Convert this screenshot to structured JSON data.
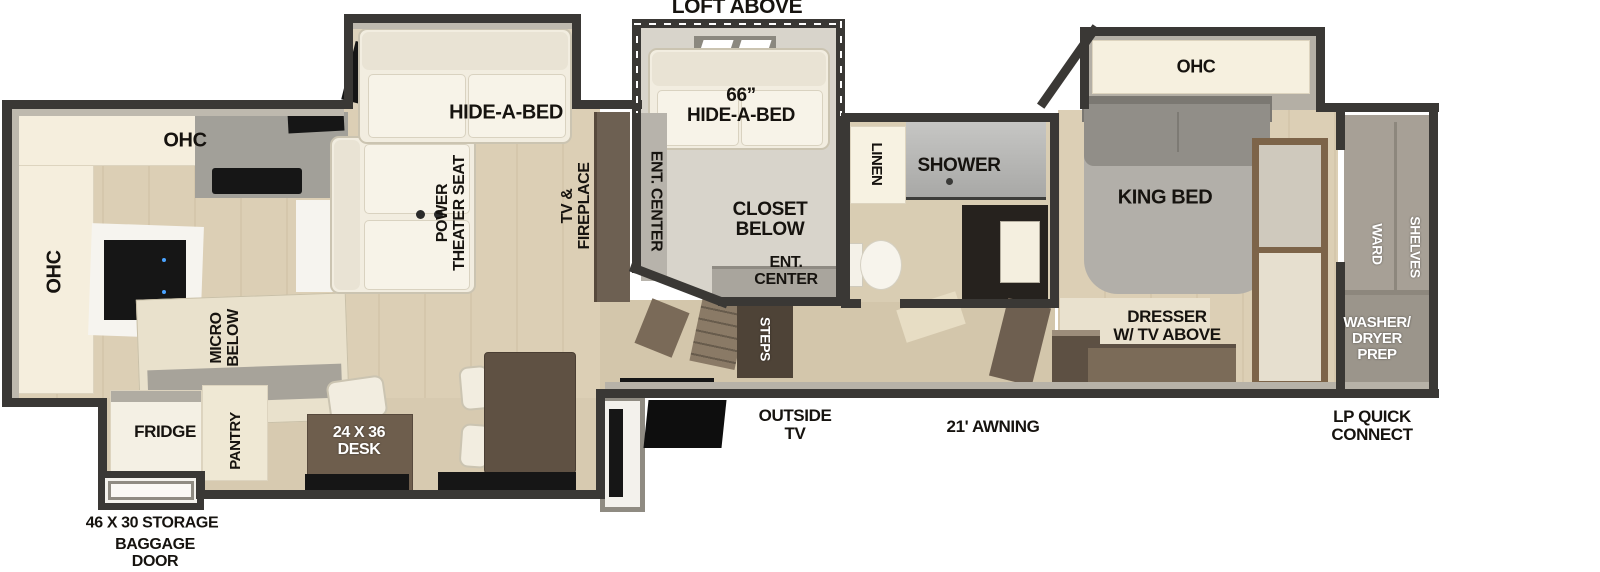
{
  "colors": {
    "wall": "#3a3835",
    "floor_wood": "#dccfb5",
    "cabinet_cream": "#f5eedd",
    "counter_gray": "#a2a099",
    "sofa_white": "#f2ede0",
    "desk_brown": "#6e5e4d",
    "steps_brown": "#4e4337",
    "shower_gray": "#b5b5b3",
    "label_black": "#16130f",
    "label_white": "#ffffff"
  },
  "exterior": {
    "loft_above": "LOFT ABOVE",
    "storage": "46 X 30 STORAGE",
    "baggage_door": [
      "BAGGAGE",
      "DOOR"
    ],
    "outside_tv": [
      "OUTSIDE",
      "TV"
    ],
    "awning": "21' AWNING",
    "lp_quick_connect": [
      "LP QUICK",
      "CONNECT"
    ]
  },
  "kitchen": {
    "ohc_top": "OHC",
    "ohc_left": "OHC",
    "micro_below": [
      "MICRO",
      "BELOW"
    ],
    "fridge": "FRIDGE",
    "pantry": "PANTRY",
    "desk": [
      "24 X 36",
      "DESK"
    ]
  },
  "living": {
    "hide_a_bed": "HIDE-A-BED",
    "theater_seat": [
      "POWER",
      "THEATER SEAT"
    ],
    "tv_fireplace": [
      "TV &",
      "FIREPLACE"
    ]
  },
  "loft": {
    "hide_a_bed_66": [
      "66”",
      "HIDE-A-BED"
    ],
    "ent_center_side": "ENT. CENTER",
    "closet_below": [
      "CLOSET",
      "BELOW"
    ],
    "ent_center_lower": [
      "ENT.",
      "CENTER"
    ],
    "steps": "STEPS"
  },
  "bathroom": {
    "linen": "LINEN",
    "shower": "SHOWER"
  },
  "bedroom": {
    "ohc": "OHC",
    "king_bed": "KING BED",
    "dresser": [
      "DRESSER",
      "W/ TV ABOVE"
    ]
  },
  "rear_closet": {
    "ward": "WARD",
    "shelves": "SHELVES",
    "washer_dryer": [
      "WASHER/",
      "DRYER",
      "PREP"
    ]
  }
}
